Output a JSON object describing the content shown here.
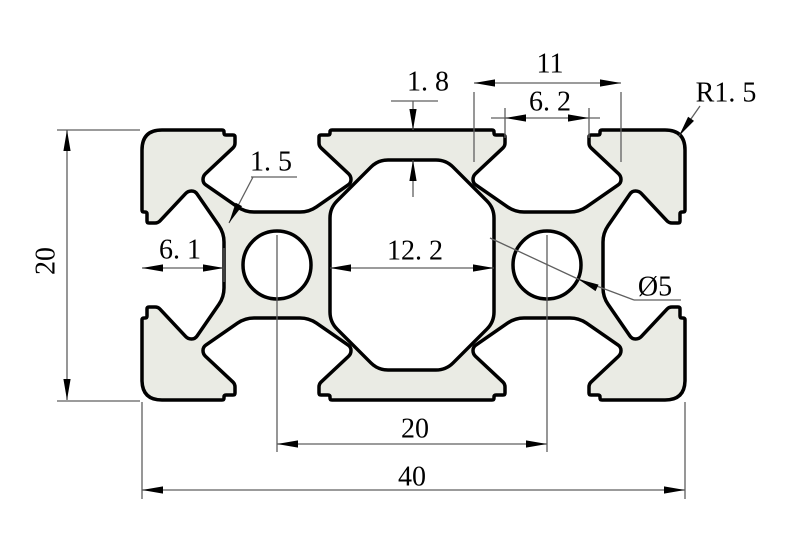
{
  "canvas": {
    "background": "#ffffff",
    "profile_fill": "#eaebe4",
    "outline_color": "#000000",
    "dim_line_color": "#5f5f5f",
    "text_color": "#000000"
  },
  "dimensions": {
    "overall_height": {
      "label": "20"
    },
    "overall_width": {
      "label": "40"
    },
    "hole_spacing": {
      "label": "20"
    },
    "center_cavity_width": {
      "label": "12. 2"
    },
    "edge_to_slot_bottom": {
      "label": "6. 1"
    },
    "top_wall_thickness": {
      "label": "1. 8"
    },
    "slot_inner_width": {
      "label": "11"
    },
    "slot_opening_width": {
      "label": "6. 2"
    },
    "corner_radius": {
      "label": "R1. 5"
    },
    "wall_thickness": {
      "label": "1. 5"
    },
    "hole_diameter": {
      "label": "Ø5"
    }
  }
}
